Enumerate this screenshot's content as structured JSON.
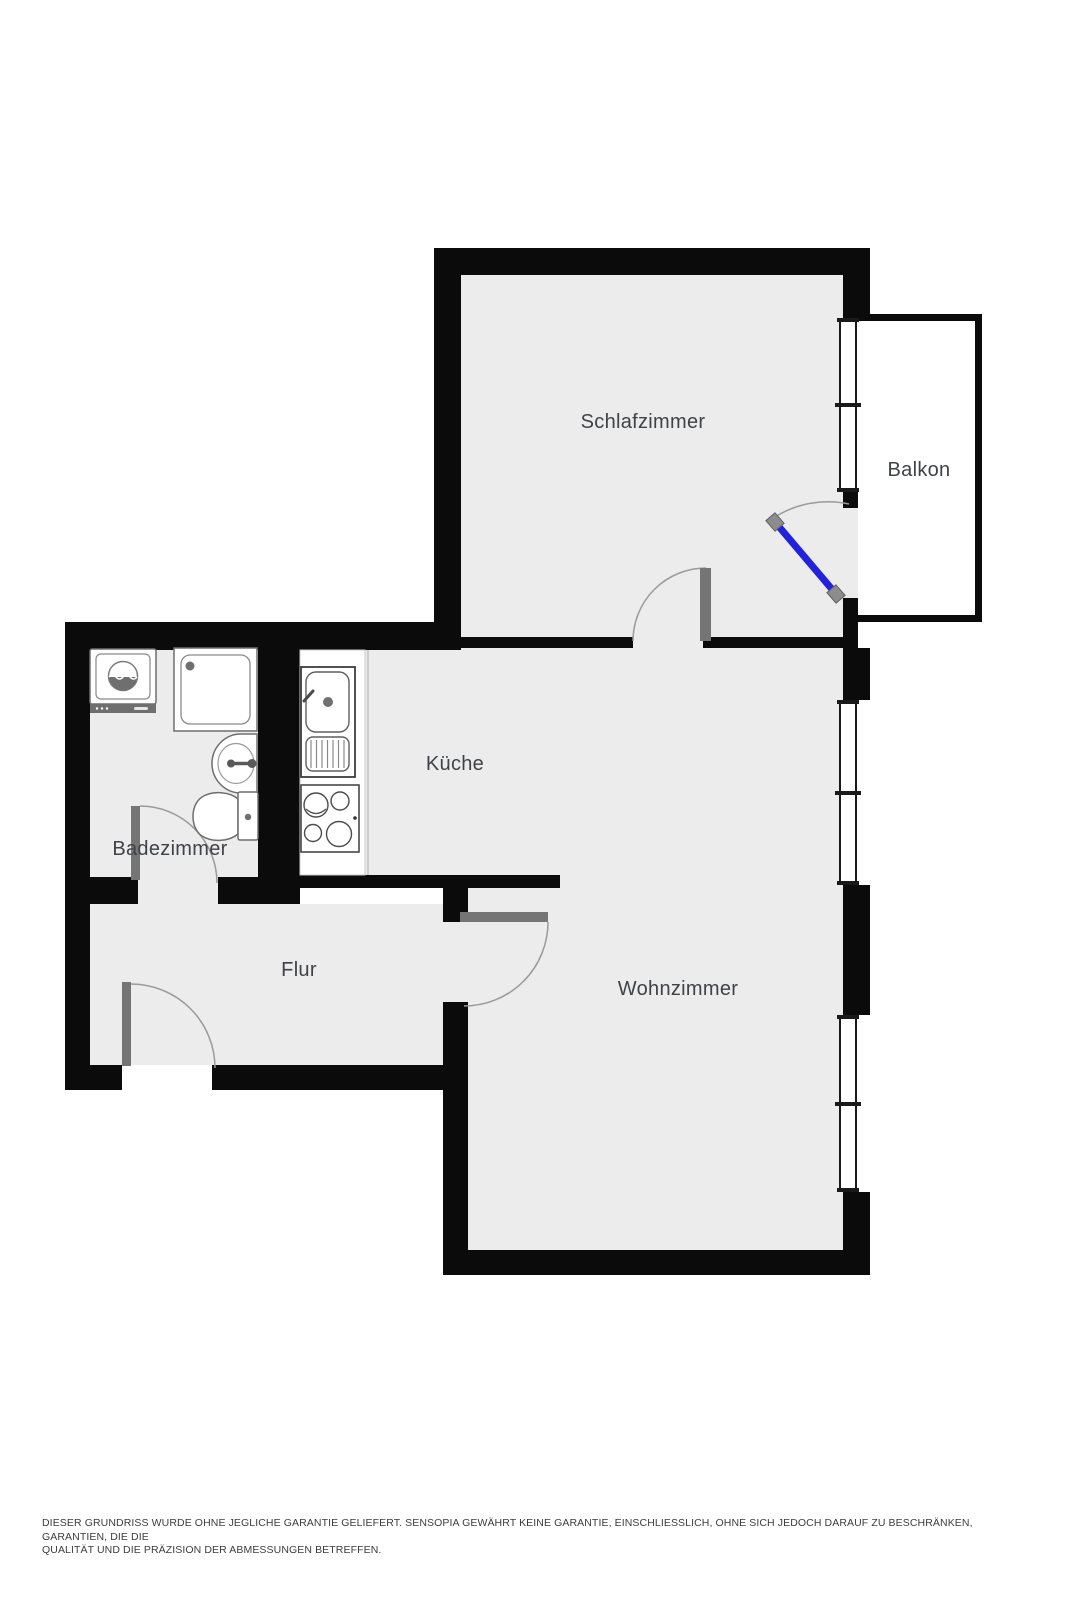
{
  "plan": {
    "colors": {
      "wall": "#0b0b0b",
      "floor": "#ececec",
      "balcony_floor": "#ffffff",
      "door": "#757575",
      "arc": "#9a9a9a",
      "balcony_door": "#2222dd",
      "door_endcap": "#8c8c8c",
      "label": "#3f4246"
    },
    "rooms": [
      {
        "id": "schlafzimmer",
        "label": "Schlafzimmer"
      },
      {
        "id": "balkon",
        "label": "Balkon"
      },
      {
        "id": "kueche",
        "label": "Küche"
      },
      {
        "id": "badezimmer",
        "label": "Badezimmer"
      },
      {
        "id": "flur",
        "label": "Flur"
      },
      {
        "id": "wohnzimmer",
        "label": "Wohnzimmer"
      }
    ],
    "fixtures": [
      {
        "icon": "washing-machine-icon",
        "room": "Badezimmer"
      },
      {
        "icon": "shower-icon",
        "room": "Badezimmer"
      },
      {
        "icon": "bathroom-sink-icon",
        "room": "Badezimmer"
      },
      {
        "icon": "toilet-icon",
        "room": "Badezimmer"
      },
      {
        "icon": "kitchen-sink-icon",
        "room": "Küche"
      },
      {
        "icon": "stove-icon",
        "room": "Küche"
      }
    ],
    "windows": 3,
    "doors": 5
  },
  "disclaimer": {
    "line1": "DIESER GRUNDRISS WURDE OHNE JEGLICHE GARANTIE GELIEFERT. SENSOPIA GEWÄHRT KEINE GARANTIE, EINSCHLIESSLICH, OHNE SICH JEDOCH DARAUF ZU BESCHRÄNKEN, GARANTIEN, DIE DIE",
    "line2": "QUALITÄT UND DIE PRÄZISION DER ABMESSUNGEN BETREFFEN."
  }
}
